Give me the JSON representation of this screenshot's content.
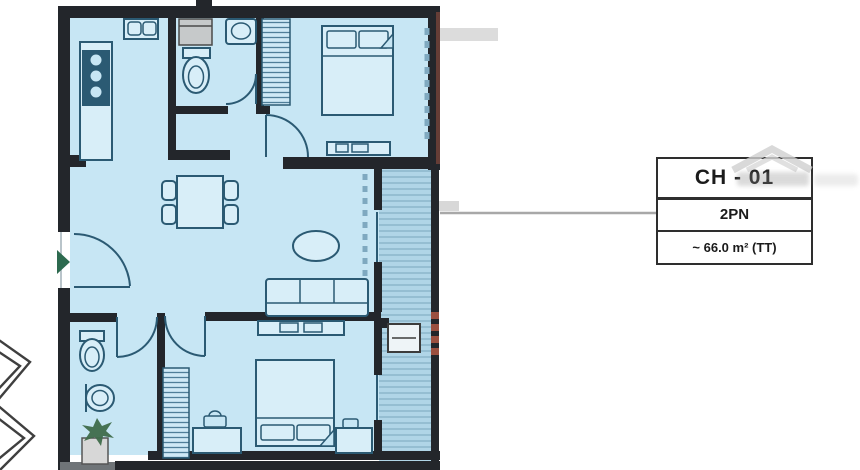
{
  "label_card": {
    "unit": "CH - 01",
    "bedrooms": "2PN",
    "area": "~ 66.0 m² (TT)"
  },
  "colors": {
    "plan_fill": "#c7e6f4",
    "balcony_fill": "#b0d5e7",
    "wall": "#23262b",
    "furniture": "#2b5a73",
    "furniture_fill": "#d8eef8",
    "entry_arrow": "#2d6a4f",
    "accent_red": "#9c5040",
    "leader": "#a8a8a8",
    "card_border": "#2e2e2e",
    "card_text": "#1b1b1b",
    "watermark": "#cfcfcf"
  },
  "floor_plan": {
    "fixtures": [
      "kitchen-sink",
      "kitchen-counter",
      "stove",
      "washing-machine",
      "toilet",
      "wash-basin",
      "bathtub-sink",
      "bed",
      "pillows",
      "wardrobe",
      "dresser",
      "dining-table",
      "dining-chair",
      "entry-door",
      "entry-arrow",
      "coffee-table",
      "sofa",
      "sliding-door",
      "window",
      "balcony",
      "ac-unit",
      "nightstand",
      "plant",
      "adjacent-unit-outline"
    ]
  }
}
